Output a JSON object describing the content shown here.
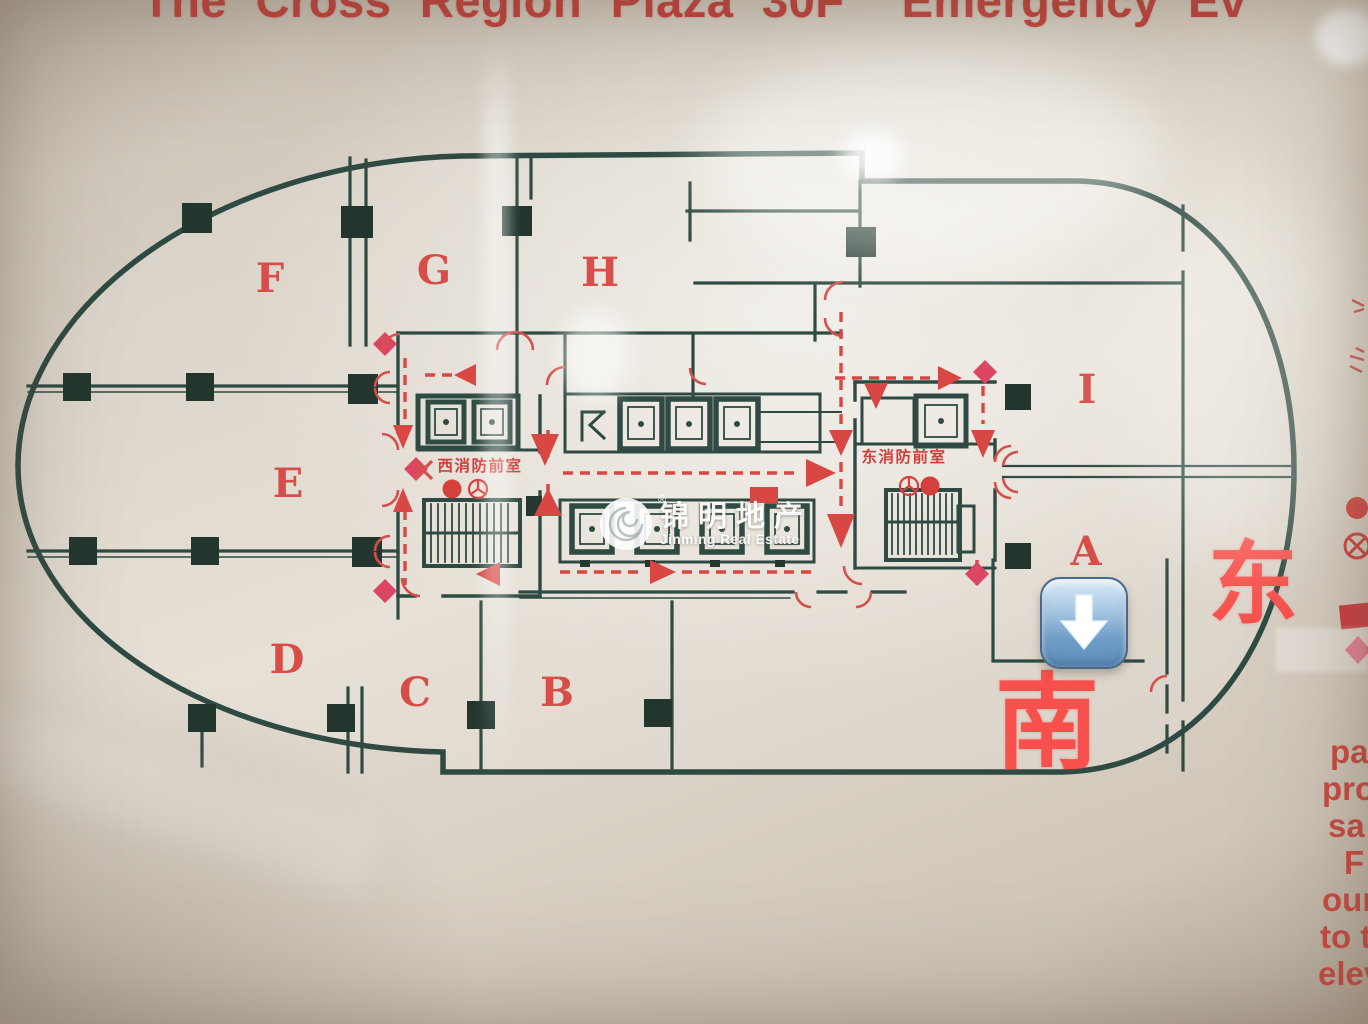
{
  "title": "The Cross Region Plaza 30F  Emergency Ev",
  "zones": [
    "F",
    "G",
    "H",
    "E",
    "I",
    "A",
    "D",
    "C",
    "B"
  ],
  "compass": {
    "east": "东",
    "south": "南"
  },
  "cores": {
    "west_label": "西消防前室",
    "east_label": "东消防前室"
  },
  "watermark": {
    "cn": "锦明地产",
    "en": "Jinming Real Estate",
    "registered": "®"
  },
  "edge_text_lines": [
    "pa",
    "pro",
    "sa",
    "F",
    "our",
    "to t",
    "elev"
  ],
  "colors": {
    "wall": "#2e4a42",
    "route_red": "#d84743",
    "title_red": "#c5403b",
    "compass_red": "#f8514d",
    "diamond_red": "#dd4663",
    "button_blue": "#6f9dc8"
  },
  "icons": {
    "sticker": "down-arrow-sticker",
    "hydrant": "fire-hydrant-dot",
    "hose_reel": "hose-reel-icon",
    "legend_symbols": [
      "fire-hydrant-dot",
      "crossed-circle-icon",
      "red-rect-marker",
      "diamond-marker"
    ]
  }
}
